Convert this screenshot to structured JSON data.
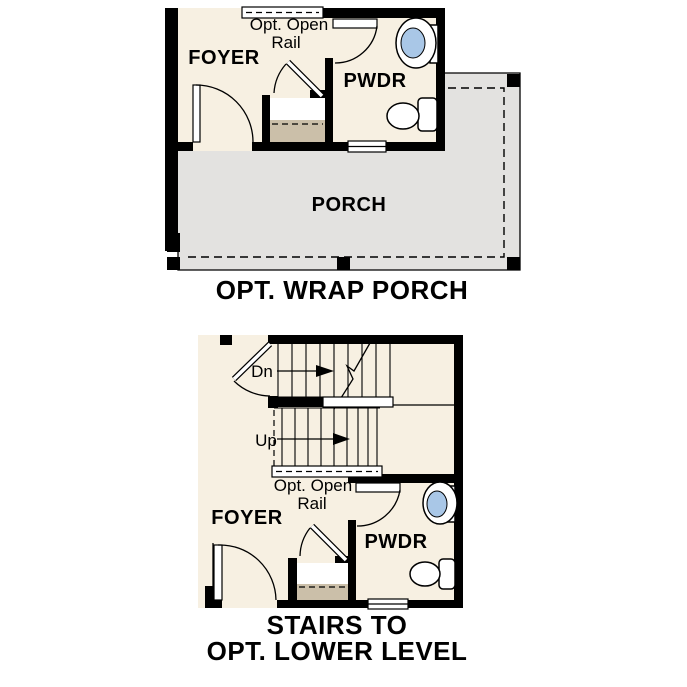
{
  "top_plan": {
    "rooms": {
      "foyer": "FOYER",
      "pwdr": "PWDR",
      "porch": "PORCH"
    },
    "rail_label": {
      "line1": "Opt. Open",
      "line2": "Rail"
    },
    "caption": "OPT. WRAP PORCH"
  },
  "bottom_plan": {
    "rooms": {
      "foyer": "FOYER",
      "pwdr": "PWDR"
    },
    "stairs": {
      "down": "Dn",
      "up": "Up"
    },
    "rail_label": {
      "line1": "Opt. Open",
      "line2": "Rail"
    },
    "caption_line1": "STAIRS TO",
    "caption_line2": "OPT. LOWER LEVEL"
  },
  "colors": {
    "wall": "#000000",
    "room_fill": "#f7f0e2",
    "porch_fill": "#e3e2e0",
    "closet_floor": "#cbbfa9",
    "sink_basin": "#a9c7e7",
    "fixture_fill": "#ffffff"
  }
}
